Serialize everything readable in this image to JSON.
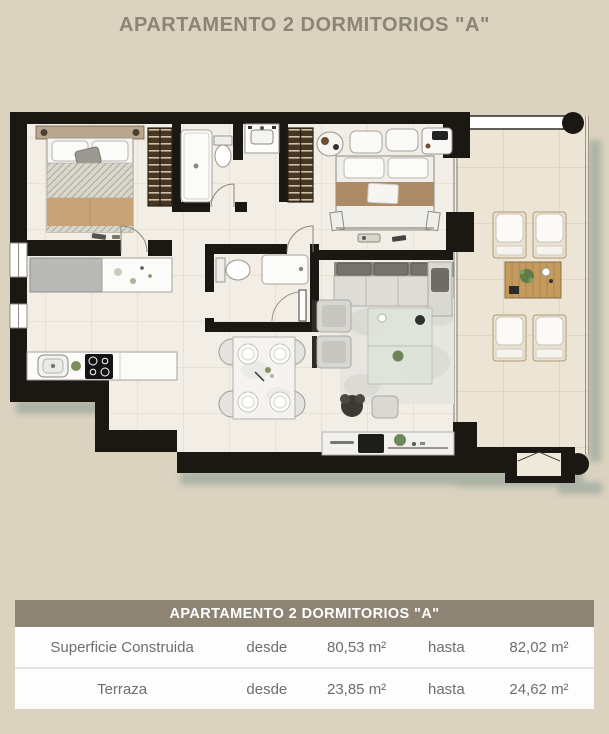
{
  "page": {
    "title": "APARTAMENTO 2 DORMITORIOS \"A\""
  },
  "summary_table": {
    "header": "APARTAMENTO 2 DORMITORIOS \"A\"",
    "rows": [
      {
        "label": "Superficie Construida",
        "from_label": "desde",
        "from_value": "80,53 m²",
        "to_label": "hasta",
        "to_value": "82,02 m²"
      },
      {
        "label": "Terraza",
        "from_label": "desde",
        "from_value": "23,85 m²",
        "to_label": "hasta",
        "to_value": "24,62 m²"
      }
    ]
  },
  "floorplan": {
    "type": "apartment-2-bedroom-top-view",
    "rooms": [
      "master-bedroom",
      "bathroom-1",
      "bedroom-2",
      "bathroom-2",
      "kitchen",
      "dining-area",
      "living-room",
      "corridor",
      "terrace"
    ],
    "colors": {
      "page_background": "#dbd3c0",
      "title_text": "#8b8577",
      "table_header_background": "#8d8473",
      "table_header_text": "#ffffff",
      "table_row_background": "#fdfdfd",
      "table_row_text": "#6e6e6e",
      "table_divider": "#e4e2de",
      "plan_wall": "#1b1713",
      "plan_floor_indoor": "#f2eee5",
      "plan_floor_terrace": "#ece5d6",
      "plan_wardrobe": "#473722",
      "plan_bed_blanket": "#c8a377",
      "plan_terrace_wood": "#c49a5d",
      "plan_shadow": "#7e948a"
    }
  }
}
